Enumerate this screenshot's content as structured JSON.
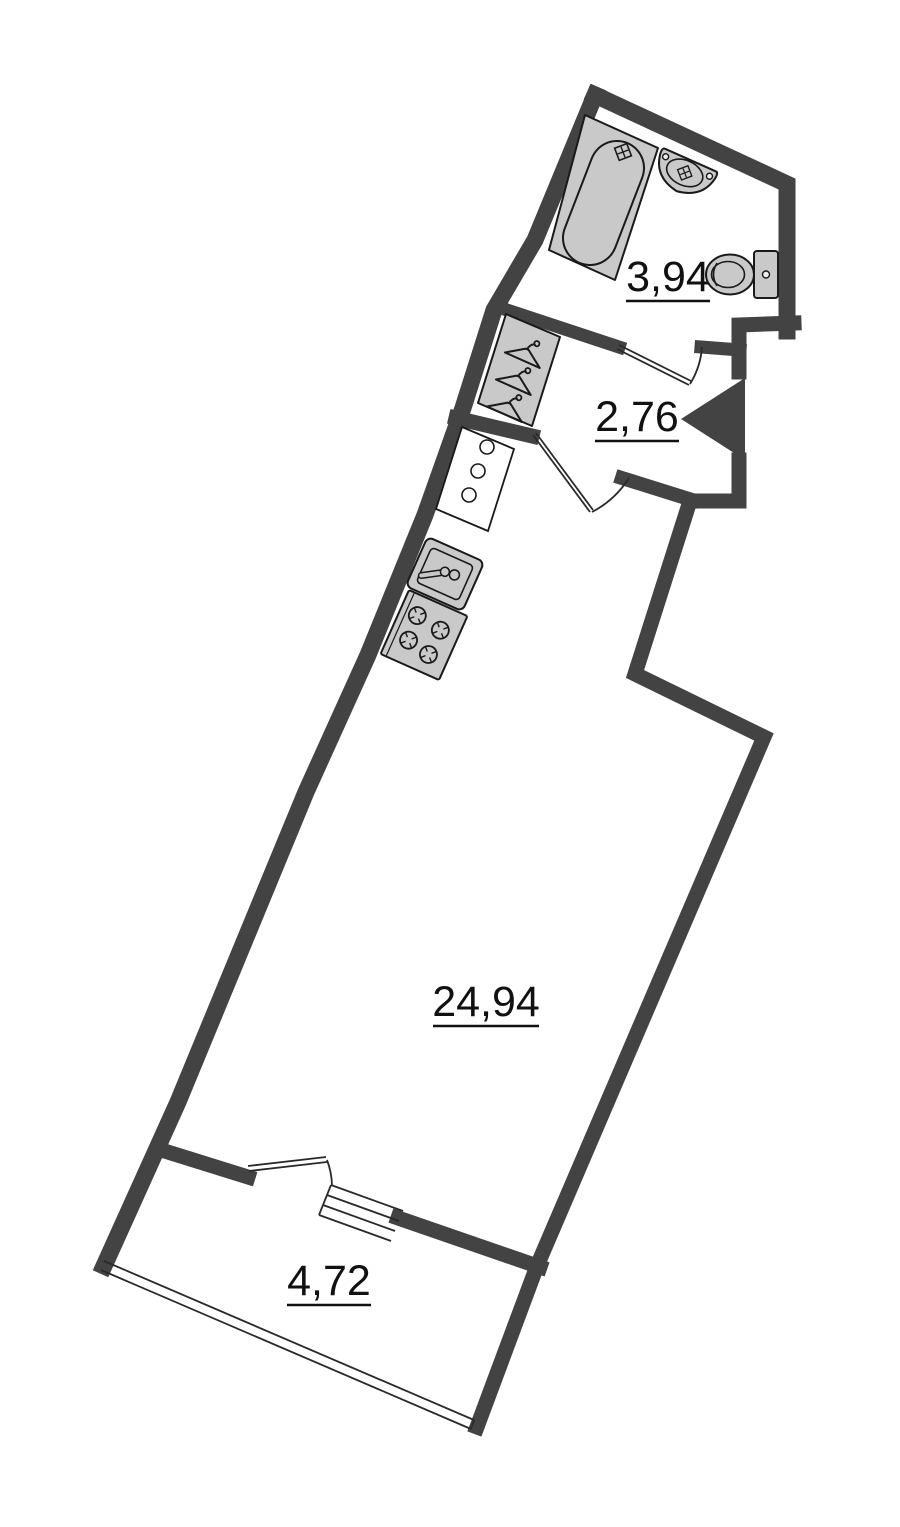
{
  "palette": {
    "wall_color": "#434343",
    "fixture_fill": "#c9c9c9",
    "fixture_stroke": "#1a1a1a",
    "line_color": "#2a2a2a",
    "label_color": "#111111",
    "bg_color": "#ffffff"
  },
  "plan": {
    "type": "apartment-floor-plan-rotated",
    "rooms": [
      {
        "name": "bathroom",
        "area_label": "3,94"
      },
      {
        "name": "hallway",
        "area_label": "2,76"
      },
      {
        "name": "living-kitchen",
        "area_label": "24,94"
      },
      {
        "name": "balcony",
        "area_label": "4,72"
      }
    ],
    "fixtures": [
      "bathtub",
      "shower-tap-icon",
      "bathroom-sink",
      "toilet",
      "wardrobe-hangers",
      "service-cabinet",
      "kitchen-sink",
      "stove",
      "bathroom-door",
      "hall-door",
      "balcony-door",
      "balcony-window",
      "balcony-glazing",
      "entrance-door-marker"
    ]
  }
}
